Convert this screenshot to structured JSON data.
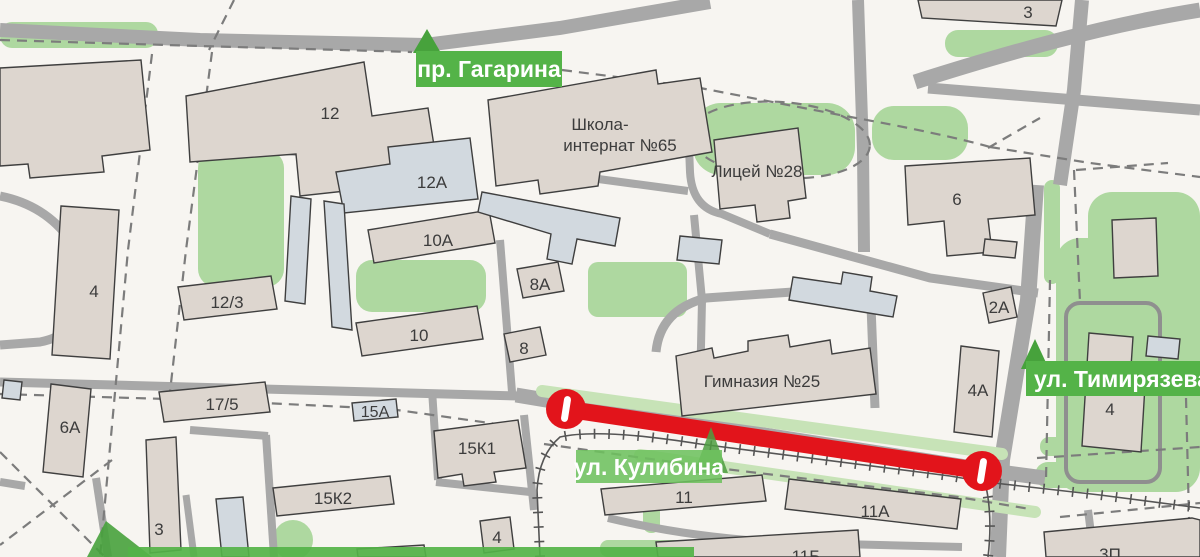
{
  "streets": {
    "gagarina": "пр. Гагарина",
    "kulibina": "ул. Кулибина",
    "timiryazeva": "ул. Тимирязева"
  },
  "schools": {
    "internat_line1": "Школа-",
    "internat_line2": "интернат №65",
    "lyceum": "Лицей №28",
    "gymnasium": "Гимназия №25"
  },
  "buildings": {
    "b12": "12",
    "b12a": "12А",
    "b10a": "10А",
    "b8a": "8А",
    "b10": "10",
    "b8": "8",
    "b12_3": "12/3",
    "b4_left": "4",
    "b6a": "6А",
    "b17_5": "17/5",
    "b15a": "15А",
    "b15k1": "15К1",
    "b15k2": "15К2",
    "b3_left": "3",
    "b4_small": "4",
    "b11": "11",
    "b11a": "11А",
    "b11b": "11Б",
    "b6": "6",
    "b3_topright": "3",
    "b2a": "2А",
    "b4a": "4А",
    "b4_right": "4",
    "b3p": "3П"
  },
  "colors": {
    "closure_red": "#e2141b",
    "label_green": "#54b348",
    "arrow_green": "#47a23c",
    "park_green": "#aed8a0",
    "building_beige": "#ddd6cf",
    "building_blue": "#d2d9df",
    "road_gray": "#a8a8a8"
  }
}
